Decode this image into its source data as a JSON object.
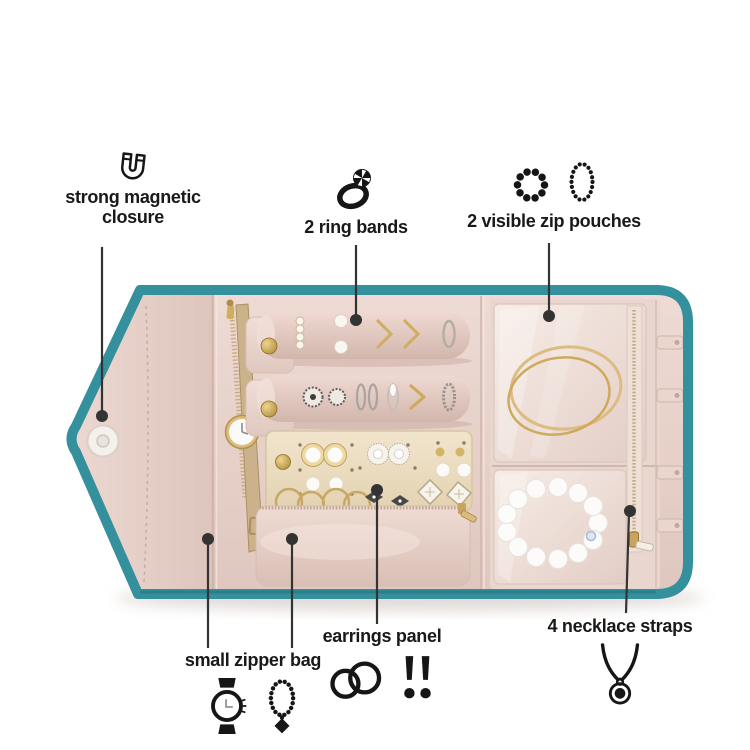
{
  "colors": {
    "background": "#ffffff",
    "trim-teal": "#35909d",
    "trim-teal-dark": "#256f7b",
    "fabric-blush": "#e7d2ca",
    "fabric-blush-deep": "#d9bfb5",
    "satin-light": "#f3e5dd",
    "panel-cream": "#efe2c8",
    "hardware-gold": "#c9a35f",
    "callout-ink": "#333333",
    "label-ink": "#191919"
  },
  "annotations": {
    "magnetic_closure": {
      "label": "strong magnetic closure",
      "icon": "magnet-icon"
    },
    "ring_bands": {
      "label": "2 ring bands",
      "icon": "ring-icon"
    },
    "zip_pouches": {
      "label": "2 visible zip pouches",
      "icons": [
        "beaded-bracelet-icon",
        "beaded-oval-icon"
      ]
    },
    "small_zipper_bag": {
      "label": "small zipper bag",
      "icons": [
        "watch-icon",
        "pendant-necklace-icon"
      ]
    },
    "earrings_panel": {
      "label": "earrings panel",
      "icons": [
        "hoop-earrings-icon",
        "stud-earrings-icon"
      ]
    },
    "necklace_straps": {
      "label": "4 necklace straps",
      "icon": "necklace-pendant-icon"
    }
  }
}
